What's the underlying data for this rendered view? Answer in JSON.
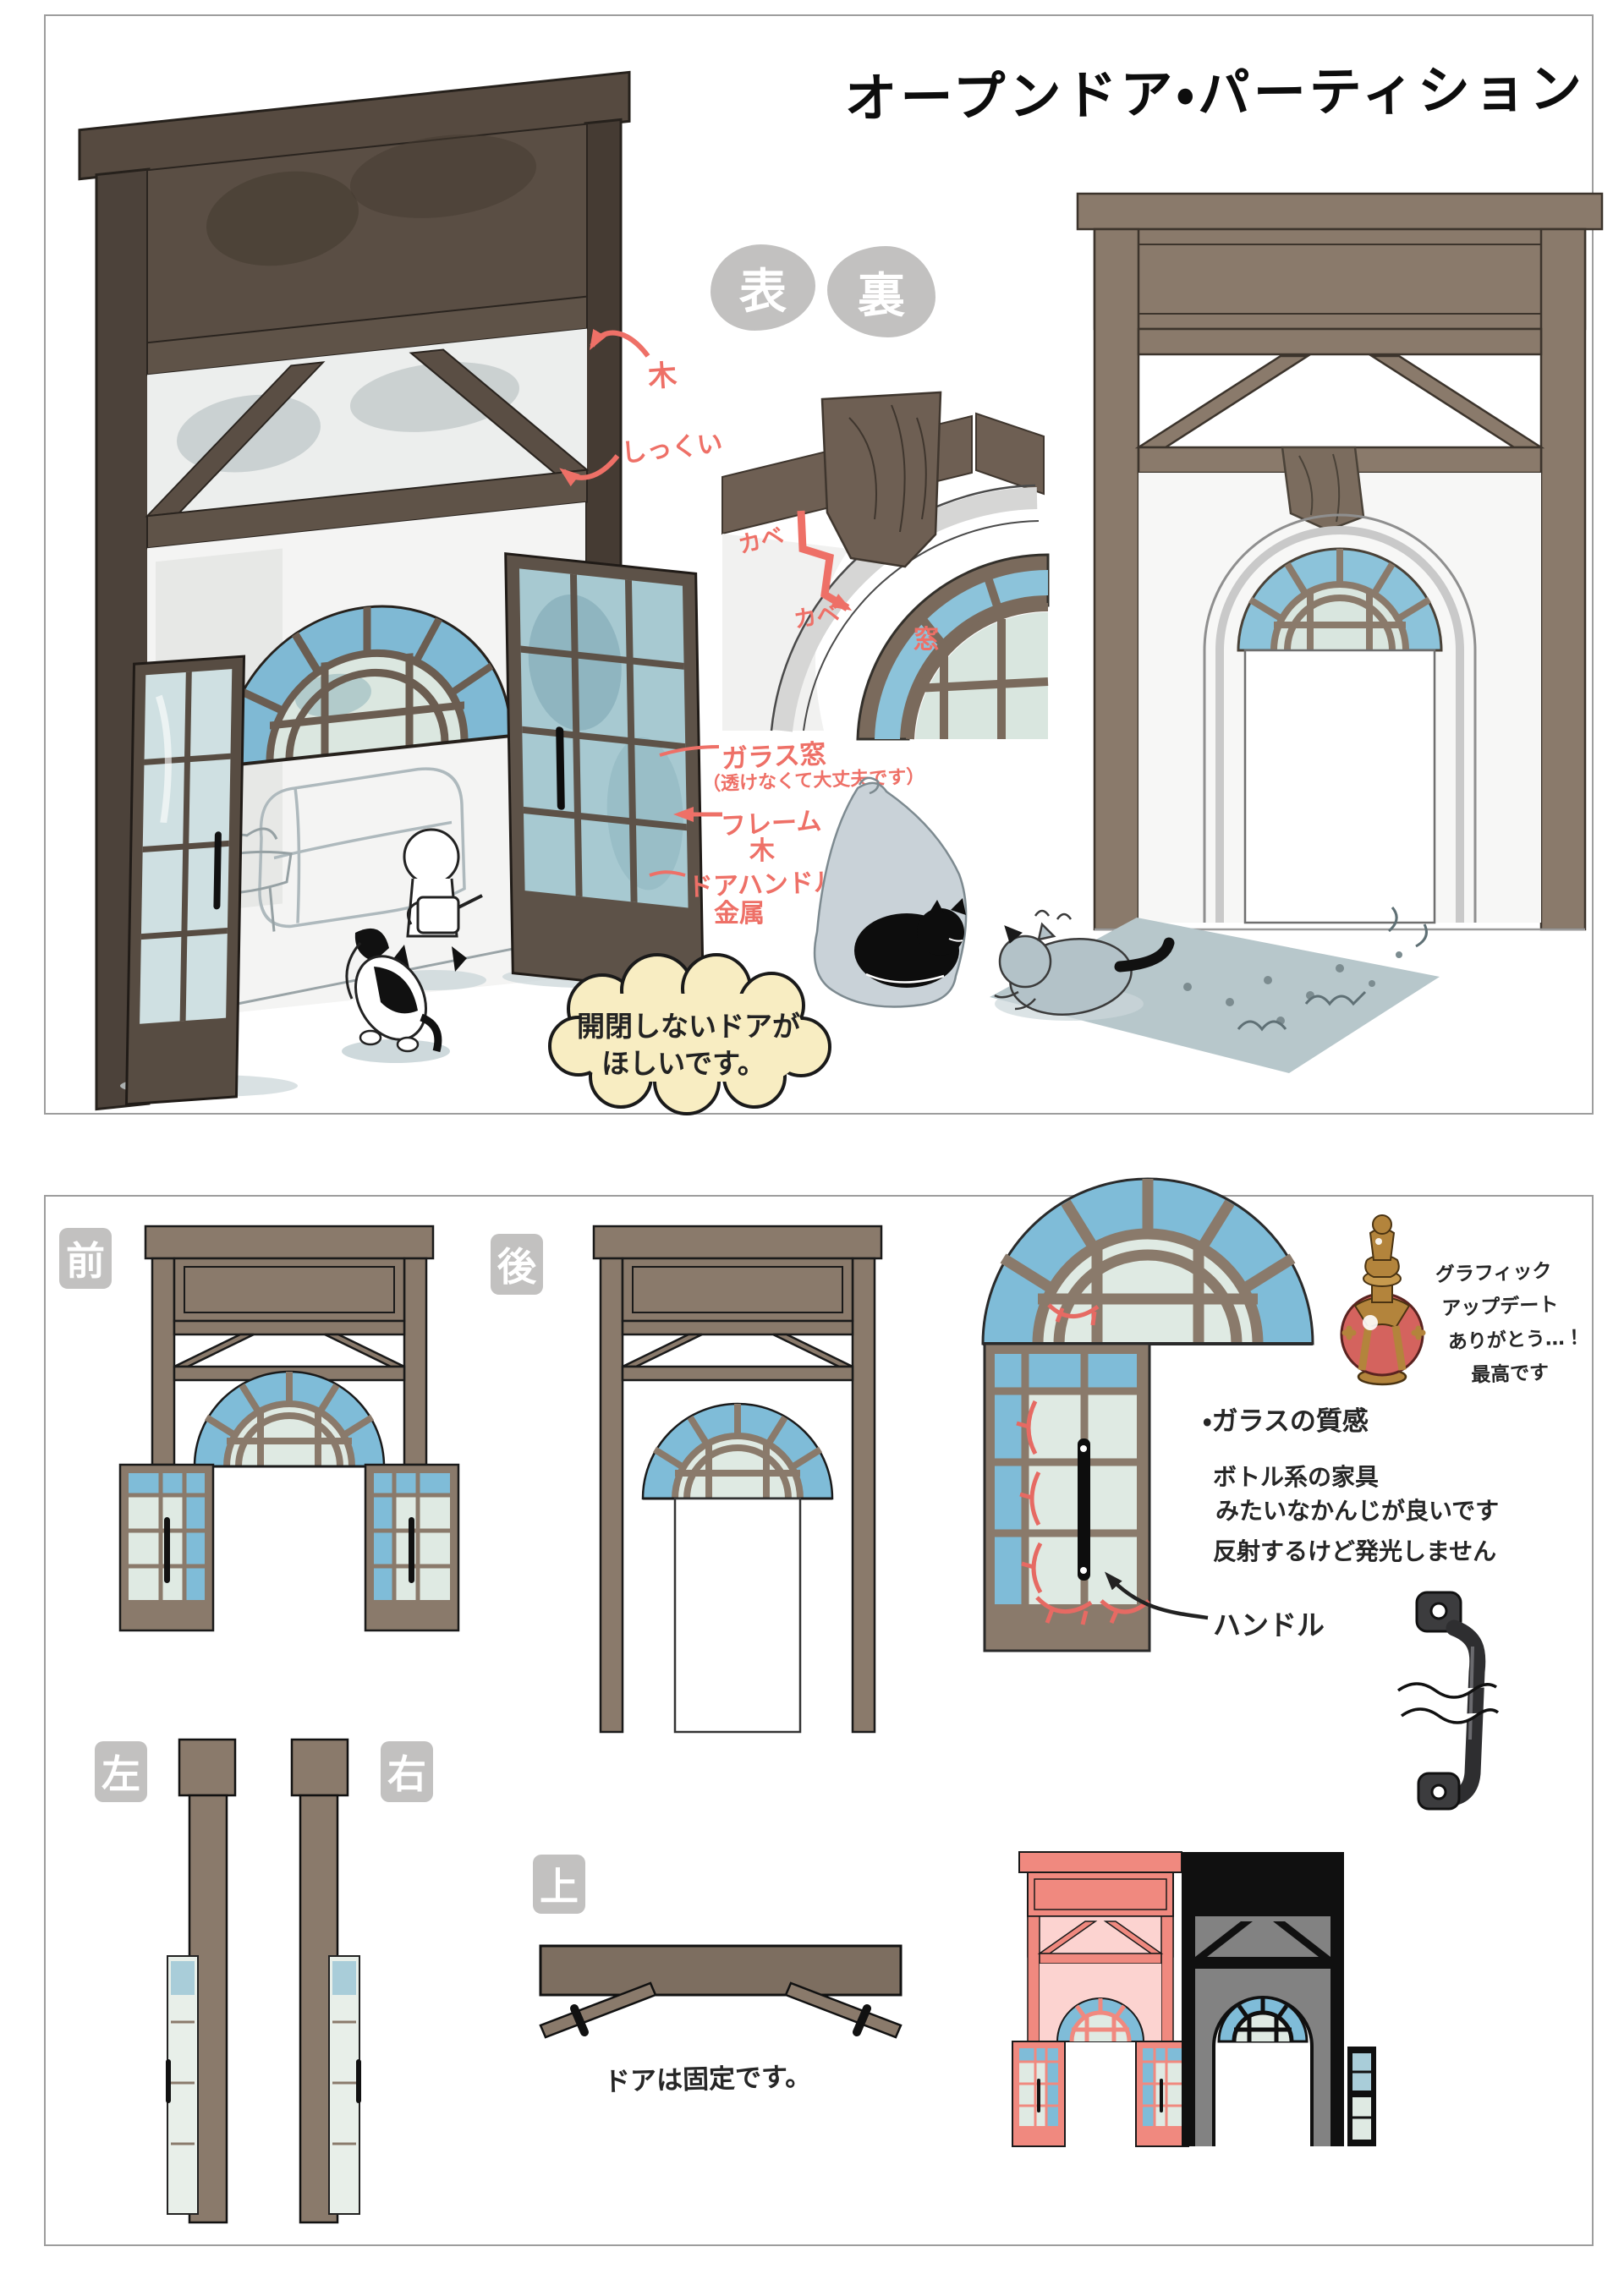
{
  "title": "オープンドア・パーティション",
  "top_panel": {
    "orientation_labels": {
      "front": "表",
      "back": "裏"
    },
    "annotations": {
      "wood": "木",
      "plaster": "しっくい",
      "wall_upper": "カベ",
      "wall_lower": "カベ",
      "window": "窓",
      "glass_window": "ガラス窓",
      "glass_window_note": "（透けなくて大丈夫です）",
      "frame_label": "フレーム",
      "frame_material": "木",
      "handle_label": "ドアハンドル",
      "handle_material": "金属"
    },
    "speech_bubble": {
      "line1": "開閉しないドアが",
      "line2": "ほしいです。"
    }
  },
  "bottom_panel": {
    "view_labels": {
      "front": "前",
      "back": "後",
      "left": "左",
      "right": "右",
      "top": "上"
    },
    "handle_callout": "ハンドル",
    "glass_notes": {
      "heading": "・ガラスの質感",
      "line1": "ボトル系の家具",
      "line2": "みたいなかんじが良いです",
      "line3": "反射するけど発光しません"
    },
    "thanks_note": {
      "line1": "グラフィック",
      "line2": "アップデート",
      "line3": "ありがとう…！",
      "line4": "最高です"
    },
    "fixed_door_note": "ドアは固定です。"
  },
  "colors": {
    "wood_brown": "#8a7a6b",
    "wood_dark": "#50463e",
    "glass_blue": "#7fbcd8",
    "glass_pale": "#dfeae3",
    "annotation_red": "#ee7067",
    "label_gray": "#c2c1c0",
    "bubble_cream": "#f8edc2",
    "variant_pink": "#f0897f",
    "variant_pink_wall": "#fcd3d0",
    "variant_black": "#101010",
    "variant_black_wall": "#828282",
    "bottle_red": "#d4635e",
    "bottle_gold": "#b3843c",
    "rug_gray_blue": "#b7c7cb"
  }
}
